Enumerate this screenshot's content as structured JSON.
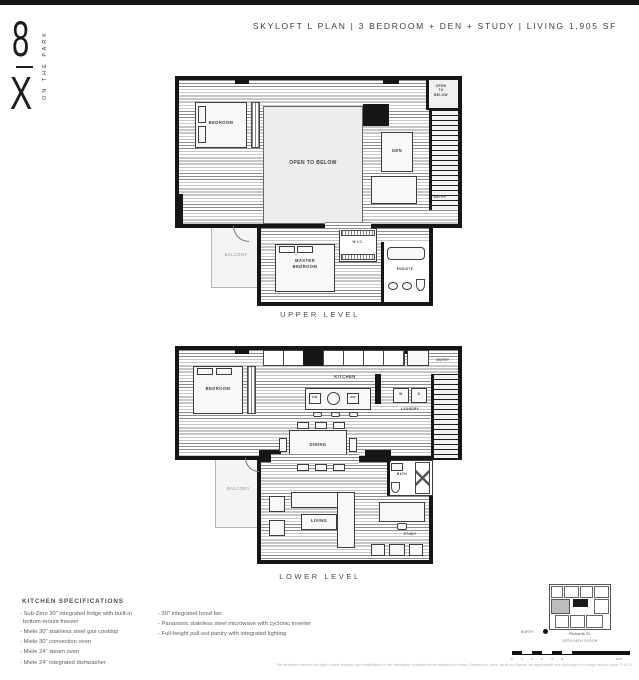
{
  "header": {
    "title": "SKYLOFT L PLAN | 3 BEDROOM + DEN + STUDY | LIVING 1,905 SF"
  },
  "logo": {
    "numeral": "8",
    "letter": "X",
    "wordmark": "ON THE PARK"
  },
  "upper": {
    "caption": "UPPER LEVEL",
    "rooms": {
      "bedroom": "BEDROOM",
      "open_to_below": "OPEN TO BELOW",
      "open_to_below_corner": "OPEN\nTO\nBELOW",
      "den": "DEN",
      "entry": "ENTRY",
      "balcony": "BALCONY",
      "master_bedroom": "MASTER\nBEDROOM",
      "wic": "W.I.C.",
      "ensuite": "ENSUITE"
    }
  },
  "lower": {
    "caption": "LOWER LEVEL",
    "rooms": {
      "bedroom": "BEDROOM",
      "kitchen": "KITCHEN",
      "laundry": "LAUNDRY",
      "washer": "W",
      "dryer": "D",
      "dishwasher": "DW",
      "microwave": "MW",
      "entry": "ENTRY",
      "dining": "DINING",
      "balcony": "BALCONY",
      "living": "LIVING",
      "bath": "BATH",
      "study": "STUDY"
    }
  },
  "specs": {
    "heading": "KITCHEN SPECIFICATIONS",
    "left": [
      "- Sub-Zero 30\" integrated fridge with built-in bottom-mount freezer",
      "- Miele 30\" stainless steel gas cooktop",
      "- Miele 30\" convection oven",
      "- Miele 24\" steam oven",
      "- Miele 24\" integrated dishwasher"
    ],
    "right": [
      "- 30\" integrated hood fan",
      "- Panasonic stainless steel microwave with cyclonic inverter",
      "- Full-height pull-out pantry with integrated lighting"
    ]
  },
  "keyplan": {
    "street": "Richards St.",
    "floors": "35TH-36TH FLOOR",
    "north_label": "NORTH"
  },
  "scalebar": {
    "ticks": [
      "0",
      "1",
      "2",
      "3",
      "4",
      "5"
    ],
    "max_label": "10 ft"
  },
  "footer": {
    "disclaimer": "The developer reserves the right to make changes and modifications to the information contained herein without prior notice. Dimensions, sizes, areas and layouts are approximate only and subject to change without notice. E.&O.E."
  },
  "colors": {
    "wall": "#161616",
    "hatch_line": "#8c8c8c",
    "open_area": "#ededed"
  }
}
